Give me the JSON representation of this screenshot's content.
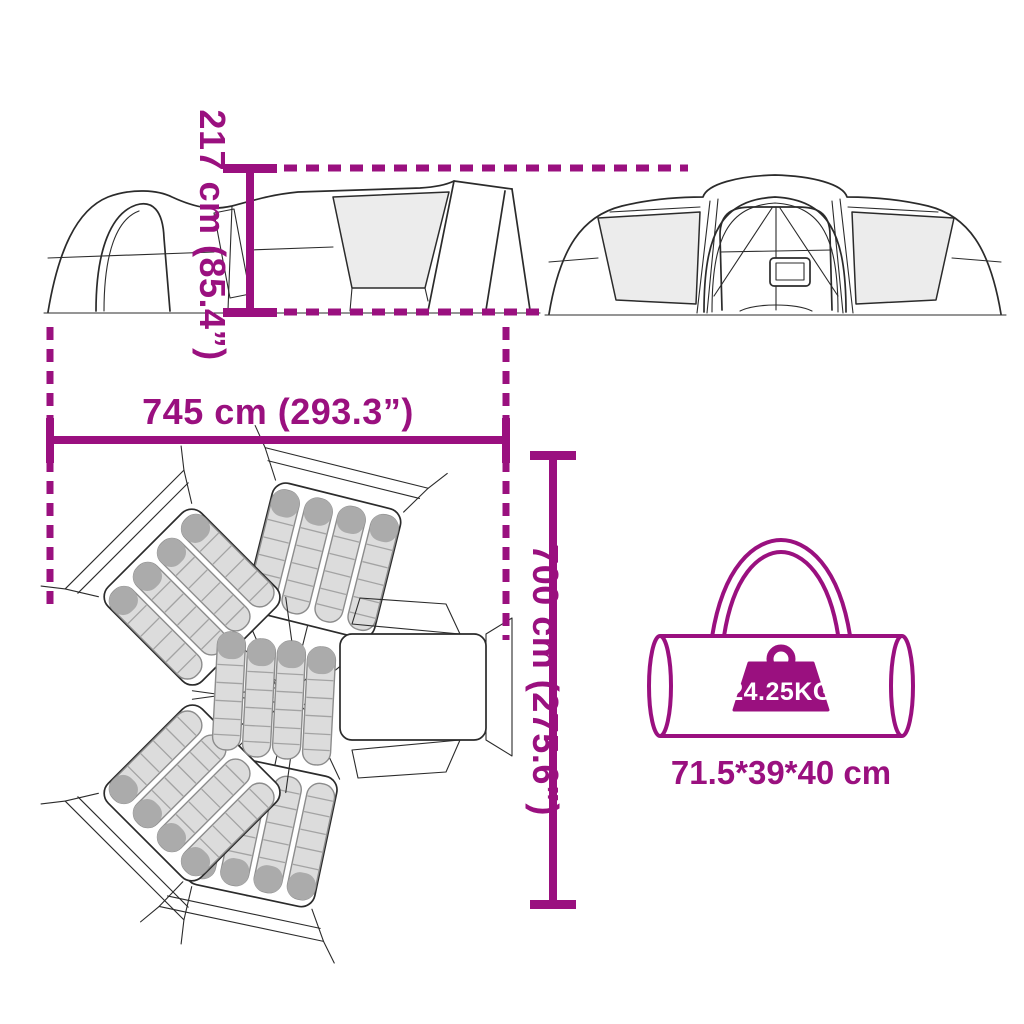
{
  "page": {
    "background_color": "#ffffff",
    "accent_color": "#9a107f",
    "artwork_line_color": "#2b2b2b",
    "mesh_panel_color": "#ececec",
    "sleeping_bag_color": "#dcdcdc"
  },
  "diagram": {
    "type": "product-dimension-diagram",
    "subject": "large family tent with star-shaped floor plan, shown in side view, front view, top view and with carry bag",
    "dimensions": {
      "height": {
        "label": "217 cm (85.4”)",
        "value_cm": 217,
        "value_in": 85.4
      },
      "length": {
        "label": "745 cm (293.3”)",
        "value_cm": 745,
        "value_in": 293.3
      },
      "depth": {
        "label": "700 cm (275.6”)",
        "value_cm": 700,
        "value_in": 275.6
      }
    },
    "carry_bag": {
      "weight_label": "24.25KG",
      "size_label": "71.5*39*40 cm"
    },
    "floor_plan": {
      "sleeping_pods": 4,
      "bags_per_pod": 4,
      "center_bags": 4,
      "porch": "right side"
    }
  }
}
